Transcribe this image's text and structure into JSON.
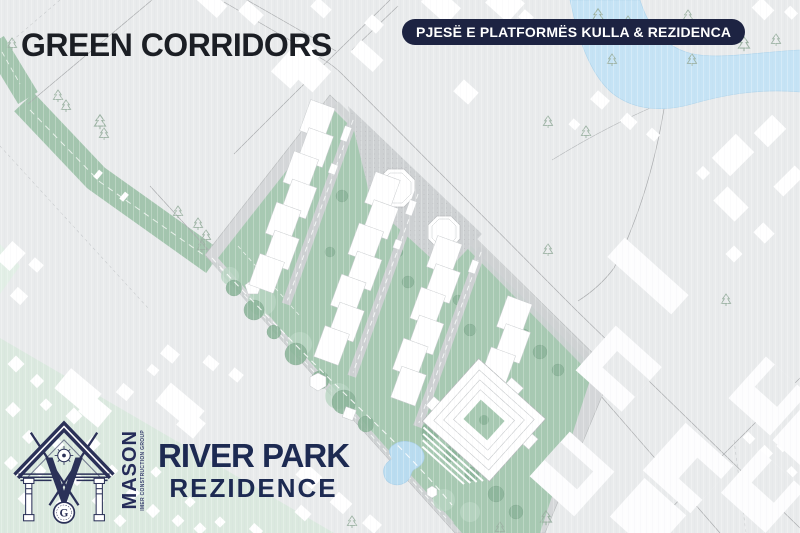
{
  "header": {
    "title": "GREEN CORRIDORS",
    "badge": "PJESË E PLATFORMËS KULLA & REZIDENCA"
  },
  "branding": {
    "company": "MASON",
    "tagline": "IMER CONSTRUCTION GROUP",
    "monogram": "G",
    "project_name": "RIVER PARK",
    "project_subtitle": "REZIDENCE"
  },
  "map": {
    "features": [
      "green-corridor",
      "river",
      "residential-site",
      "octagon-plaza",
      "courtyard-building",
      "pond",
      "pine-trees",
      "city-blocks"
    ]
  },
  "colors": {
    "background": "#e9ebec",
    "badge_navy": "#1d2342",
    "title_text": "#1b1e24",
    "project_navy": "#1d2a52",
    "corridor_green": "#a3c5ae",
    "site_green": "#a7c9b2",
    "canopy_green": "#8cb59a",
    "pale_green": "#dbe9df",
    "river_blue": "#c5e3f5",
    "paved_gray": "#d3d6d8",
    "building_white": "#ffffff"
  }
}
